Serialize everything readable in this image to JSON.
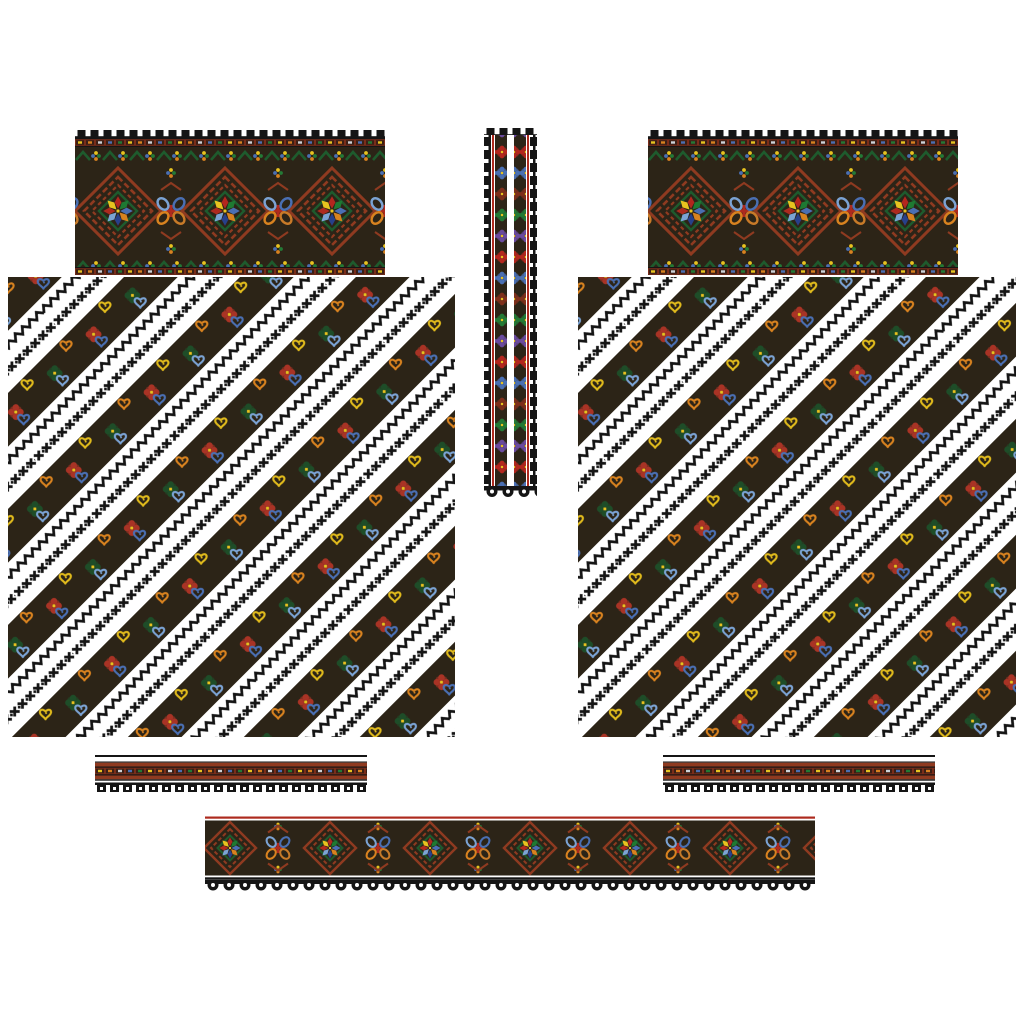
{
  "page": {
    "title": "Ukrainian cross-stitch embroidery pattern sheet (vyshyvanka shirt layout)",
    "background": "#ffffff"
  },
  "palette": {
    "ground_dark": "#2c2417",
    "meander_red": "#8f3a20",
    "band_red": "#7a2d1a",
    "crimson": "#ad2a1e",
    "green_dark": "#1e5b2d",
    "green_bright": "#237a35",
    "yellow": "#e8c31f",
    "orange": "#d8821f",
    "steel_blue": "#4a6fb3",
    "sky_blue": "#7ba3d4",
    "navy": "#27408b",
    "purple": "#6a4a9e",
    "outline_black": "#151515",
    "white": "#ffffff"
  },
  "motifs": {
    "star_petal_colors": [
      "#b3261e",
      "#1e7a32",
      "#4a6fb3",
      "#d8821f",
      "#27408b",
      "#7ba3d4",
      "#ad2a1e",
      "#e8c31f"
    ],
    "heart_outline_colors": [
      "#e0ba1c",
      "#4a6fb3",
      "#d8821f",
      "#7ba3d4"
    ],
    "neck_rosette_colors": [
      "#b3261e",
      "#4a6fb3",
      "#7e2f1b",
      "#237a35",
      "#6a4a9e"
    ],
    "border_dash_colors": [
      "#e8c31f",
      "#d8821f",
      "#ccd2d8",
      "#4a6fb3",
      "#237a35"
    ]
  },
  "panels": [
    {
      "name": "collar-band-left",
      "description": "wide ornament band: red meander diamonds with eight-point stars, chain-link motifs, picot top edge"
    },
    {
      "name": "collar-band-right",
      "description": "wide ornament band, identical to left collar band"
    },
    {
      "name": "neck-strip-center",
      "description": "narrow vertical strip with two columns of rosettes, red rails and picot tooth edges, scalloped bottom"
    },
    {
      "name": "sleeve-panel-left",
      "description": "large panel of diagonal dark ornament stripes with red rosettes, green clovers, colored hearts, sawtooth and cross-chain lines on white"
    },
    {
      "name": "sleeve-panel-right",
      "description": "large diagonal-stripe panel, identical to left sleeve panel"
    },
    {
      "name": "cuff-strip-left",
      "description": "narrow horizontal band with colored dash row and black picot tooth edge"
    },
    {
      "name": "cuff-strip-right",
      "description": "narrow horizontal band, identical to left cuff strip"
    },
    {
      "name": "hem-band-bottom",
      "description": "long ornament band with star diamonds and chain links, ring-scallop bottom edge"
    }
  ]
}
